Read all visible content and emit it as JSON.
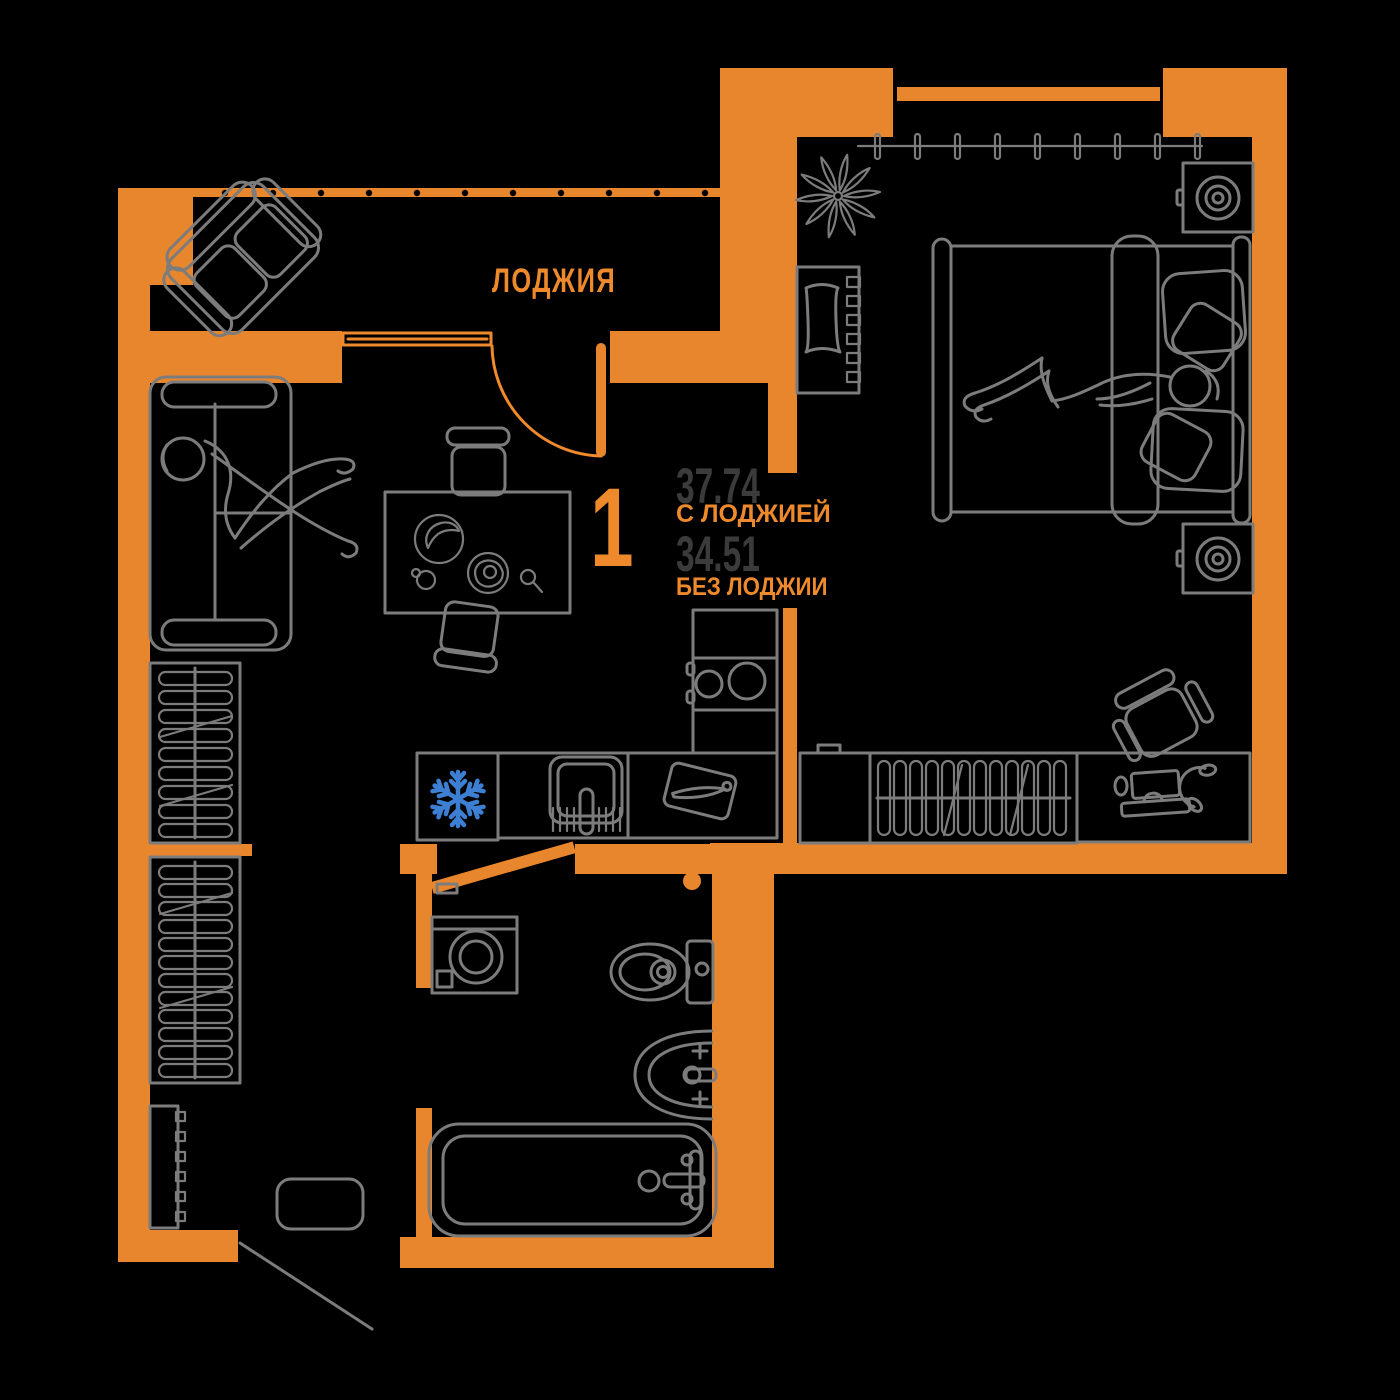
{
  "plan": {
    "loggia_label": "ЛОДЖИЯ",
    "rooms_count": "1",
    "area_with_loggia": {
      "value": "37.74",
      "caption": "С ЛОДЖИЕЙ"
    },
    "area_without_loggia": {
      "value": "34.51",
      "caption": "БЕЗ ЛОДЖИИ"
    }
  },
  "colors": {
    "wall": "#E8862E",
    "accent": "#EE8A2B",
    "line": "#7C7C7C",
    "dark-text": "#3B3B3B",
    "snowflake-blue": "#3D7FD2",
    "background": "#000000"
  },
  "icons": {
    "fridge_badge": "snowflake-icon"
  }
}
